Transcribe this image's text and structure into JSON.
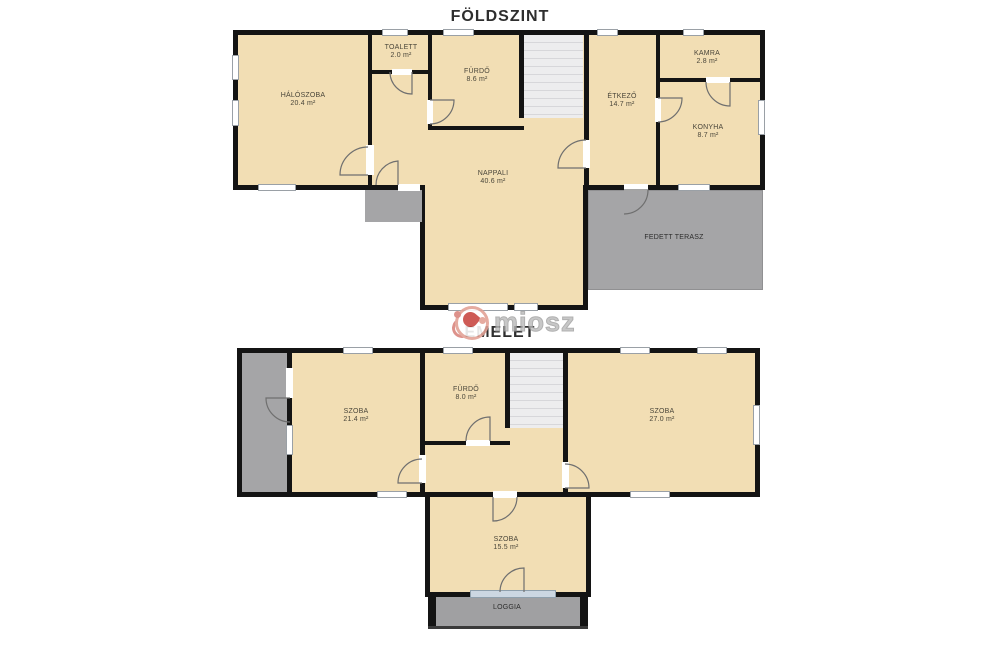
{
  "ground": {
    "title": "FÖLDSZINT",
    "rooms": [
      {
        "name": "HÁLÓSZOBA",
        "area": "20.4 m²"
      },
      {
        "name": "TOALETT",
        "area": "2.0 m²"
      },
      {
        "name": "FÜRDŐ",
        "area": "8.6 m²"
      },
      {
        "name": "NAPPALI",
        "area": "40.6 m²"
      },
      {
        "name": "ÉTKEZŐ",
        "area": "14.7 m²"
      },
      {
        "name": "KAMRA",
        "area": "2.8 m²"
      },
      {
        "name": "KONYHA",
        "area": "8.7 m²"
      },
      {
        "name": "FEDETT TERASZ",
        "area": ""
      }
    ]
  },
  "upper": {
    "title": "EMELET",
    "rooms": [
      {
        "name": "SZOBA",
        "area": "21.4 m²"
      },
      {
        "name": "FÜRDŐ",
        "area": "8.0 m²"
      },
      {
        "name": "SZOBA",
        "area": "27.0 m²"
      },
      {
        "name": "SZOBA",
        "area": "15.5 m²"
      },
      {
        "name": "LOGGIA",
        "area": ""
      }
    ]
  },
  "watermark": {
    "text": "miosz"
  },
  "colors": {
    "floor_fill": "#f2deb4",
    "wall": "#141414",
    "terrace_gray": "#a5a5a7",
    "stairs": "#ededee",
    "loggia_window": "#ccd7e2"
  }
}
